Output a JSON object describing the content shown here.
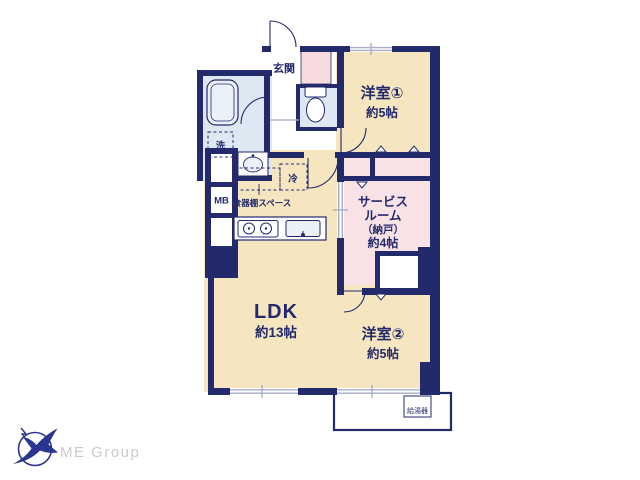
{
  "plan": {
    "rooms": {
      "genkan": "玄関",
      "yoshitsu1_name": "洋室①",
      "yoshitsu1_size": "約5帖",
      "service_l1": "サービス",
      "service_l2": "ルーム",
      "service_l3": "（納戸）",
      "service_l4": "約4帖",
      "ldk_name": "LDK",
      "ldk_size": "約13帖",
      "yoshitsu2_name": "洋室②",
      "yoshitsu2_size": "約5帖"
    },
    "fixtures": {
      "washer": "洗",
      "fridge": "冷",
      "meter_box": "MB",
      "cupboard": "食器棚スペース",
      "water_heater": "給湯器"
    }
  },
  "logo": {
    "text": "ME Group"
  },
  "colors": {
    "wall": "#232a6c",
    "room_cream": "#f6e6c0",
    "service_pink": "#f8e2e6",
    "closet_pink": "#f6dade",
    "wet_blue": "#dde8f2",
    "window_gray": "#a7aec6",
    "logo_navy": "#2b3490",
    "logo_text_gray": "#c9c9cf"
  }
}
